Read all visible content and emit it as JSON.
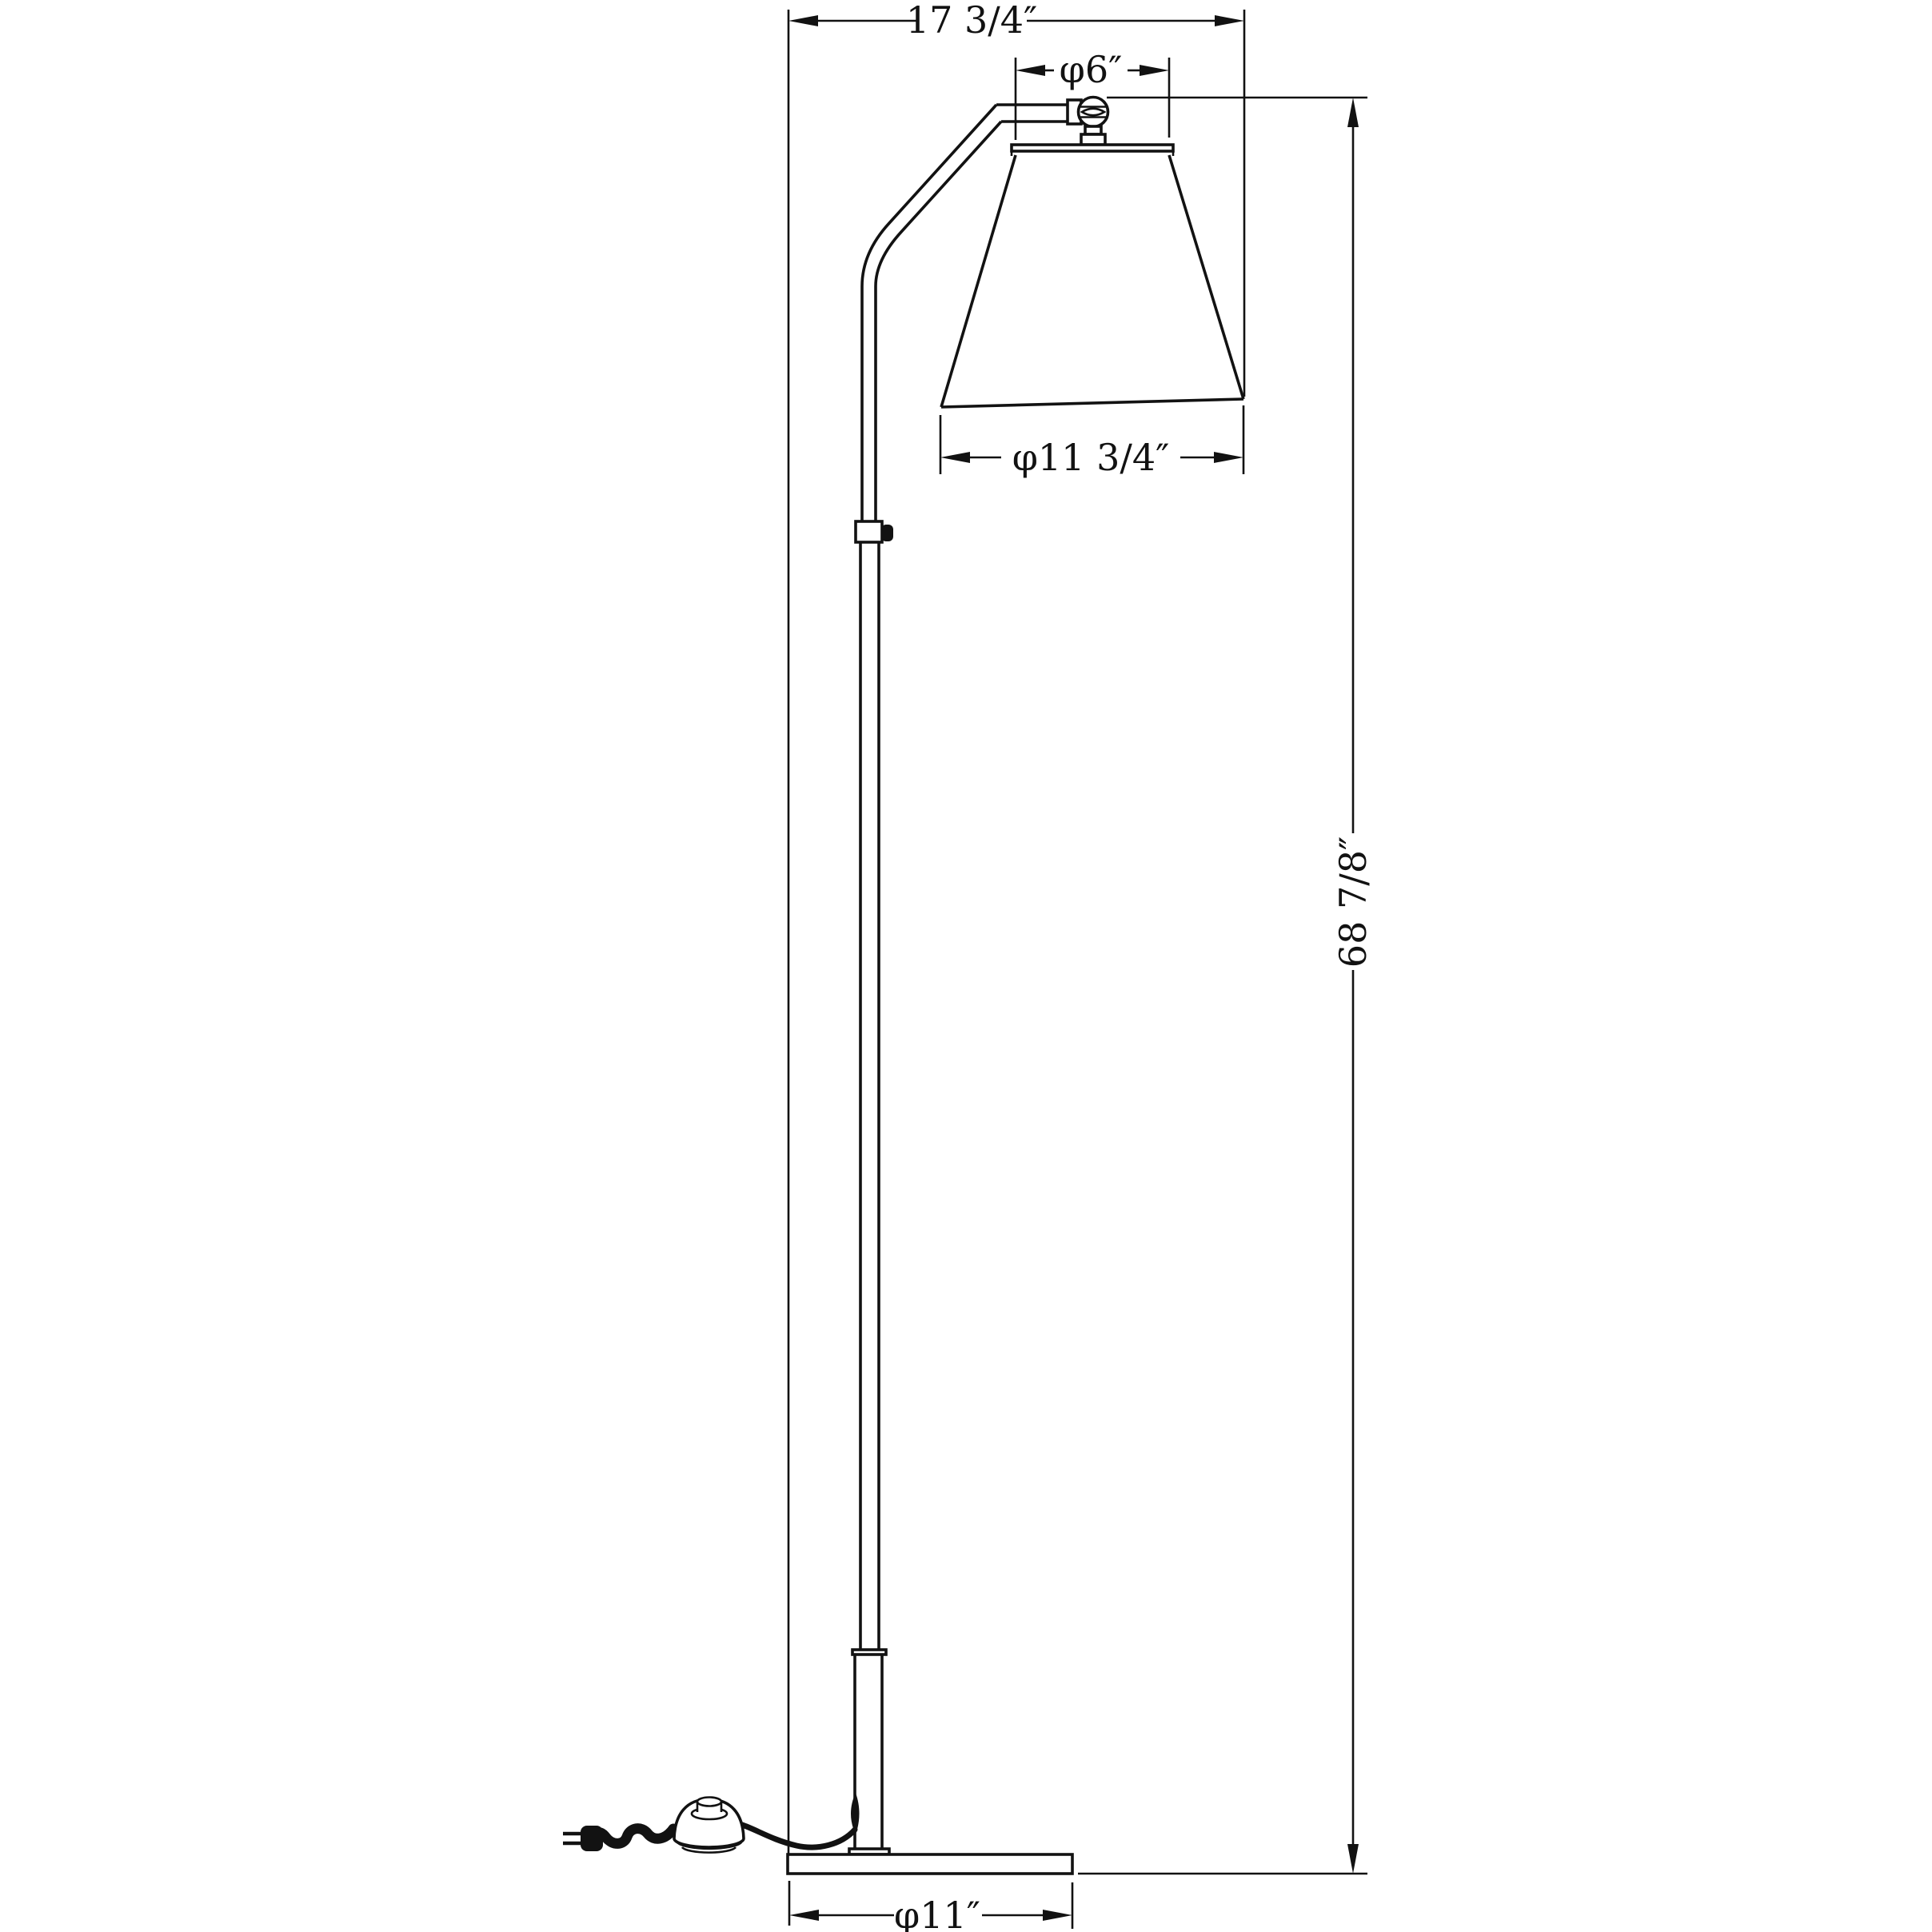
{
  "drawing": {
    "type": "technical-dimension-drawing",
    "subject": "floor-lamp",
    "background_color": "#ffffff",
    "line_color": "#121212",
    "dimensions": {
      "overall_width_label": "17 3/4″",
      "shade_top_diameter_label": "φ6″",
      "shade_bottom_diameter_label": "φ11 3/4″",
      "overall_height_label": "68 7/8″",
      "base_diameter_label": "φ11″"
    }
  }
}
